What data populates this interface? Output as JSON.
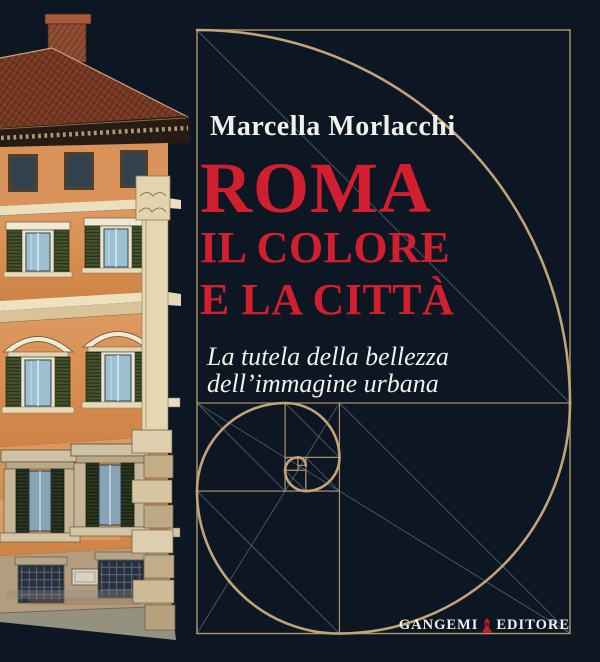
{
  "book_cover": {
    "author": "Marcella Morlacchi",
    "title": {
      "line1": "ROMA",
      "line2": "IL COLORE",
      "line3": "E LA CITTÀ"
    },
    "subtitle": {
      "line1": "La tutela della bellezza",
      "line2": "dell’immagine urbana"
    },
    "publisher": {
      "name_left": "GANGEMI",
      "name_right": "EDITORE"
    },
    "icons": {
      "publisher_mark": "obelisk-icon",
      "left_art": "palazzo-watercolor-illustration",
      "right_art": "golden-spiral-diagram"
    },
    "colors": {
      "background": "#0d1623",
      "title_red": "#d21f2f",
      "text_white": "#f0efe9",
      "gold_line": "#ad9468",
      "gold_arc": "#c2a477",
      "construction_gray": "#7e93a6",
      "publisher_mark_red": "#b5202c"
    }
  }
}
